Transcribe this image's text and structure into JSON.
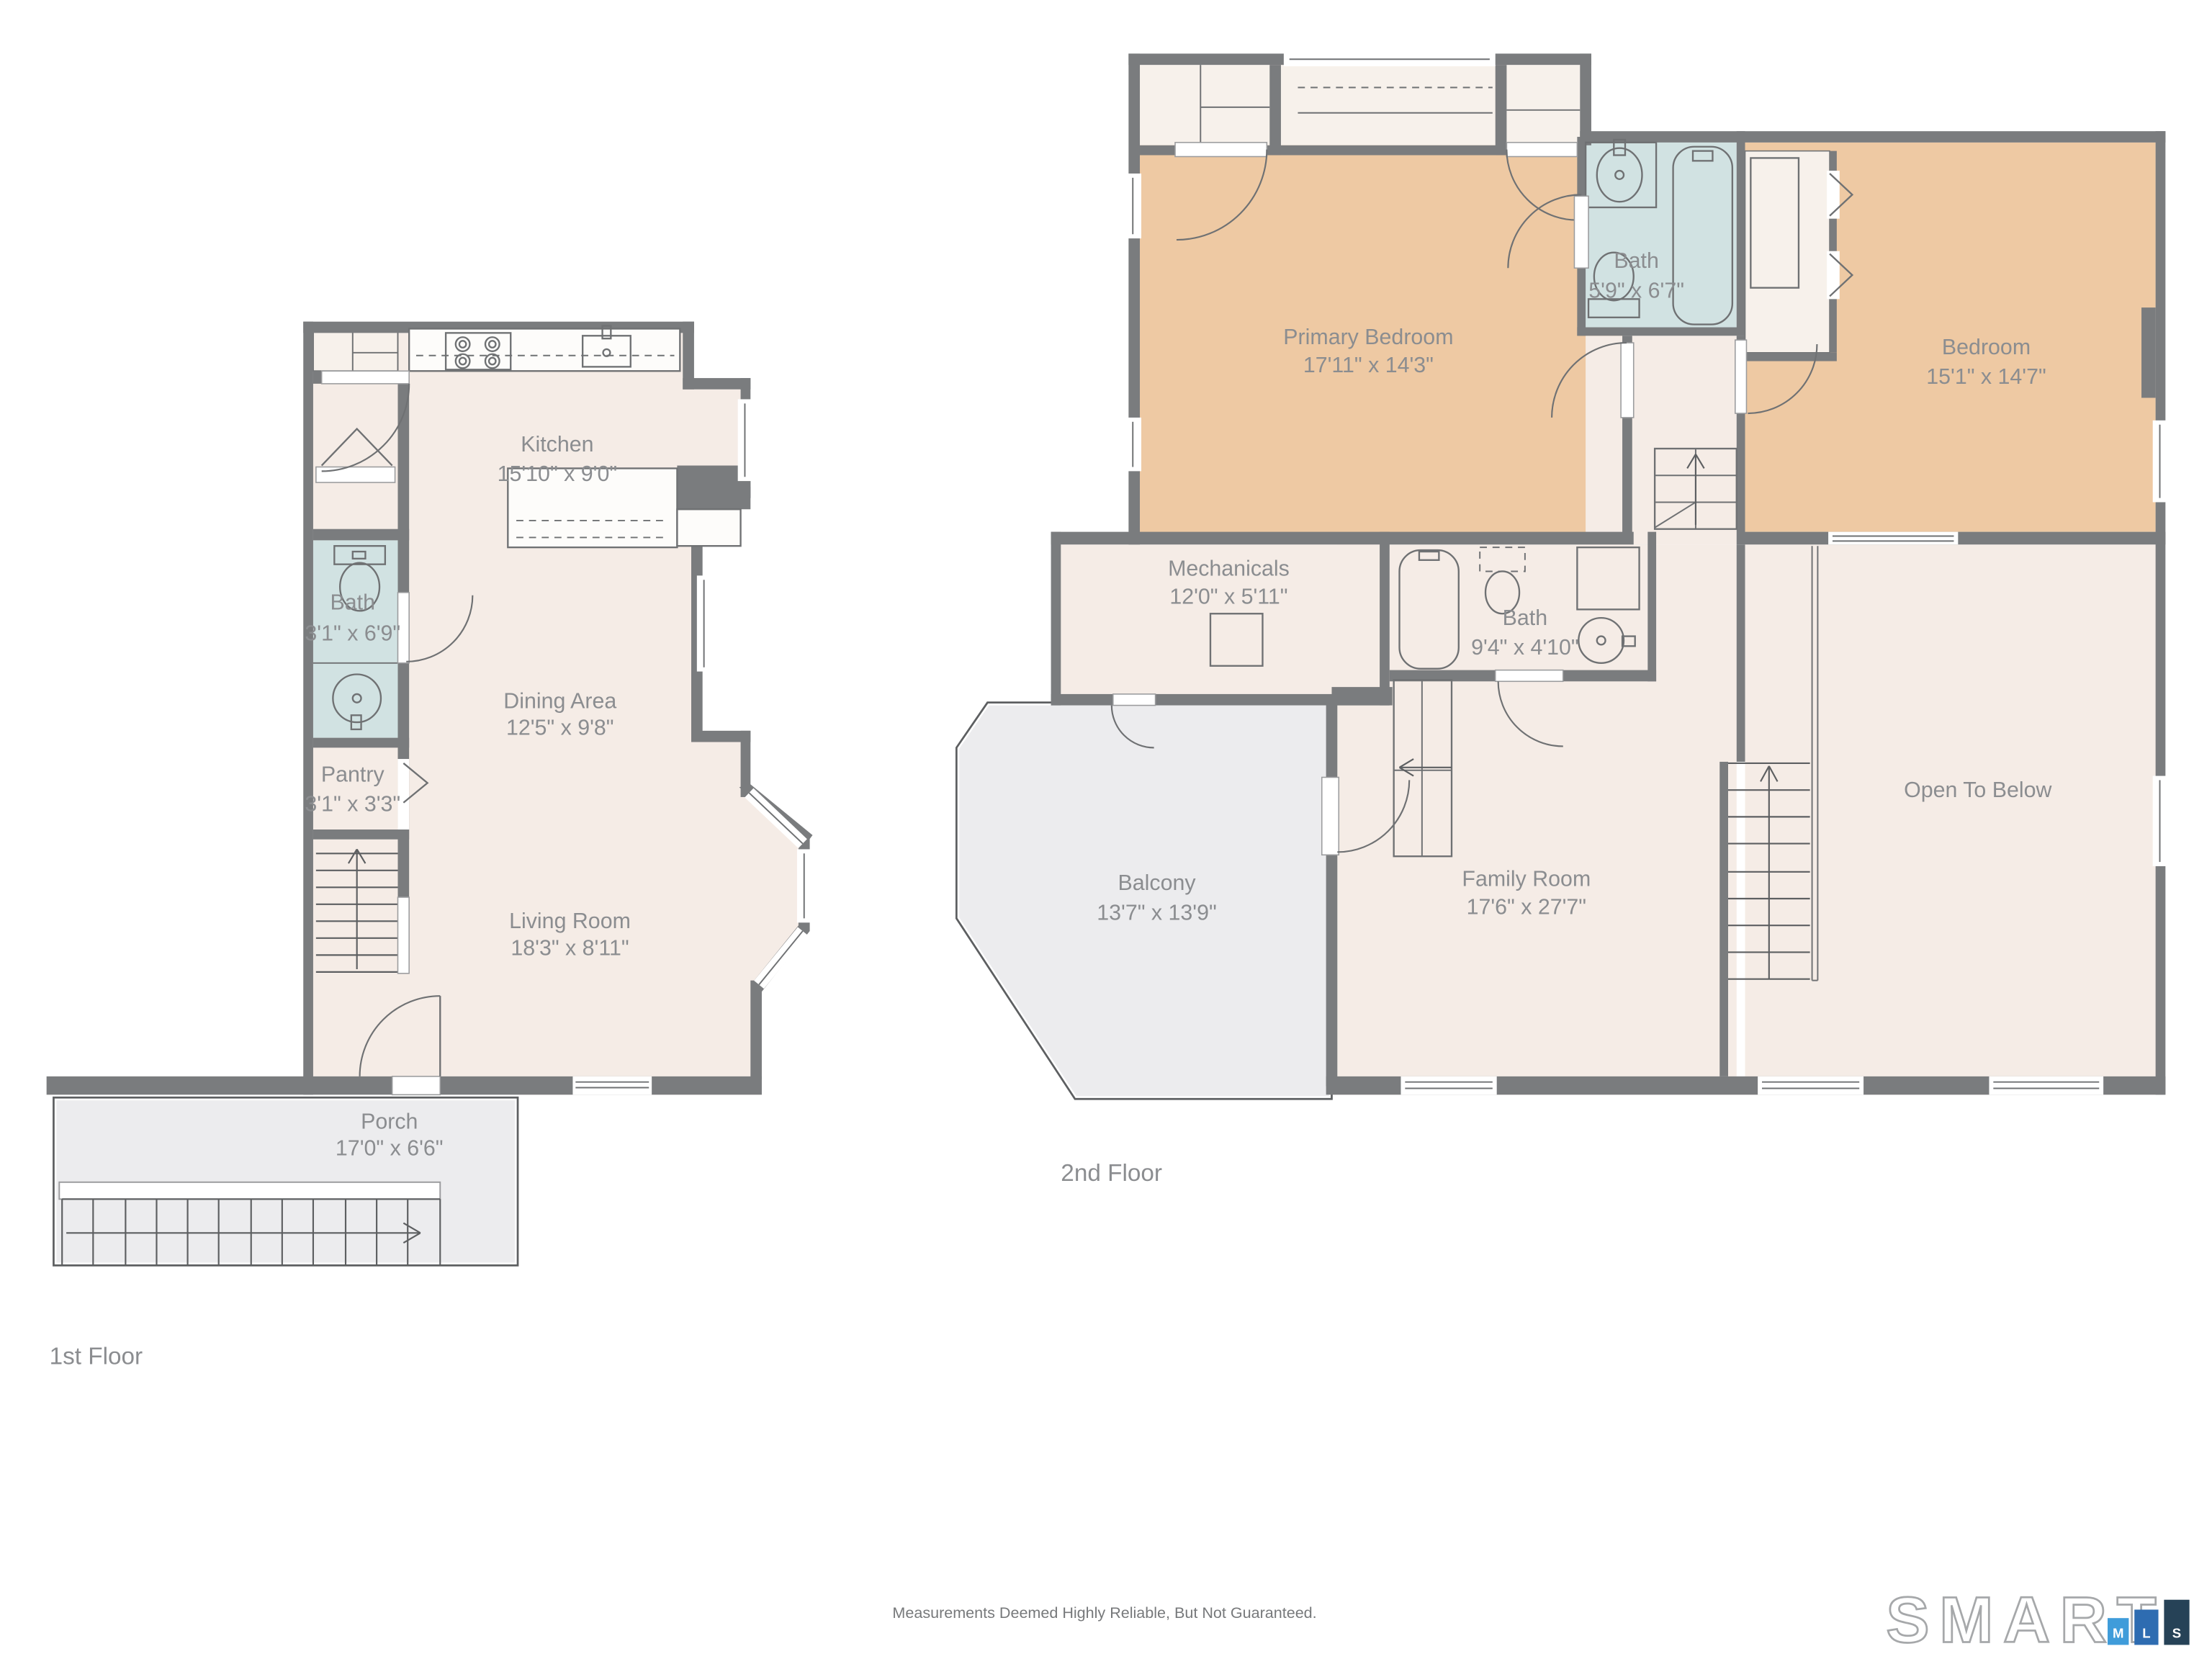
{
  "floors": [
    {
      "label": "1st Floor",
      "rooms": [
        {
          "name": "Kitchen",
          "dims": "15'10\" x 9'0\""
        },
        {
          "name": "Bath",
          "dims": "3'1\" x 6'9\""
        },
        {
          "name": "Dining Area",
          "dims": "12'5\" x 9'8\""
        },
        {
          "name": "Pantry",
          "dims": "3'1\" x 3'3\""
        },
        {
          "name": "Living Room",
          "dims": "18'3\" x 8'11\""
        },
        {
          "name": "Porch",
          "dims": "17'0\" x 6'6\""
        }
      ]
    },
    {
      "label": "2nd Floor",
      "rooms": [
        {
          "name": "Primary Bedroom",
          "dims": "17'11\" x 14'3\""
        },
        {
          "name": "Bath",
          "dims": "5'9\" x 6'7\""
        },
        {
          "name": "Bedroom",
          "dims": "15'1\" x 14'7\""
        },
        {
          "name": "Mechanicals",
          "dims": "12'0\" x 5'11\""
        },
        {
          "name": "Bath",
          "dims": "9'4\" x 4'10\""
        },
        {
          "name": "Balcony",
          "dims": "13'7\" x 13'9\""
        },
        {
          "name": "Family Room",
          "dims": "17'6\" x 27'7\""
        },
        {
          "name": "Open To Below",
          "dims": ""
        }
      ]
    }
  ],
  "footer": {
    "disclaimer": "Measurements Deemed Highly Reliable, But Not Guaranteed."
  },
  "logo": {
    "word": "SMART",
    "blocks": [
      {
        "letter": "M",
        "color": "#3f9cda"
      },
      {
        "letter": "L",
        "color": "#2e6cb1"
      },
      {
        "letter": "S",
        "color": "#264257"
      }
    ]
  },
  "colors": {
    "wall": "#7a7c7e",
    "room_fill": "#f5ece6",
    "bath_fill": "#d1e2e2",
    "bedroom_fill": "#eec9a3",
    "deck_fill": "#ececee",
    "label_text": "#8b8d90"
  }
}
